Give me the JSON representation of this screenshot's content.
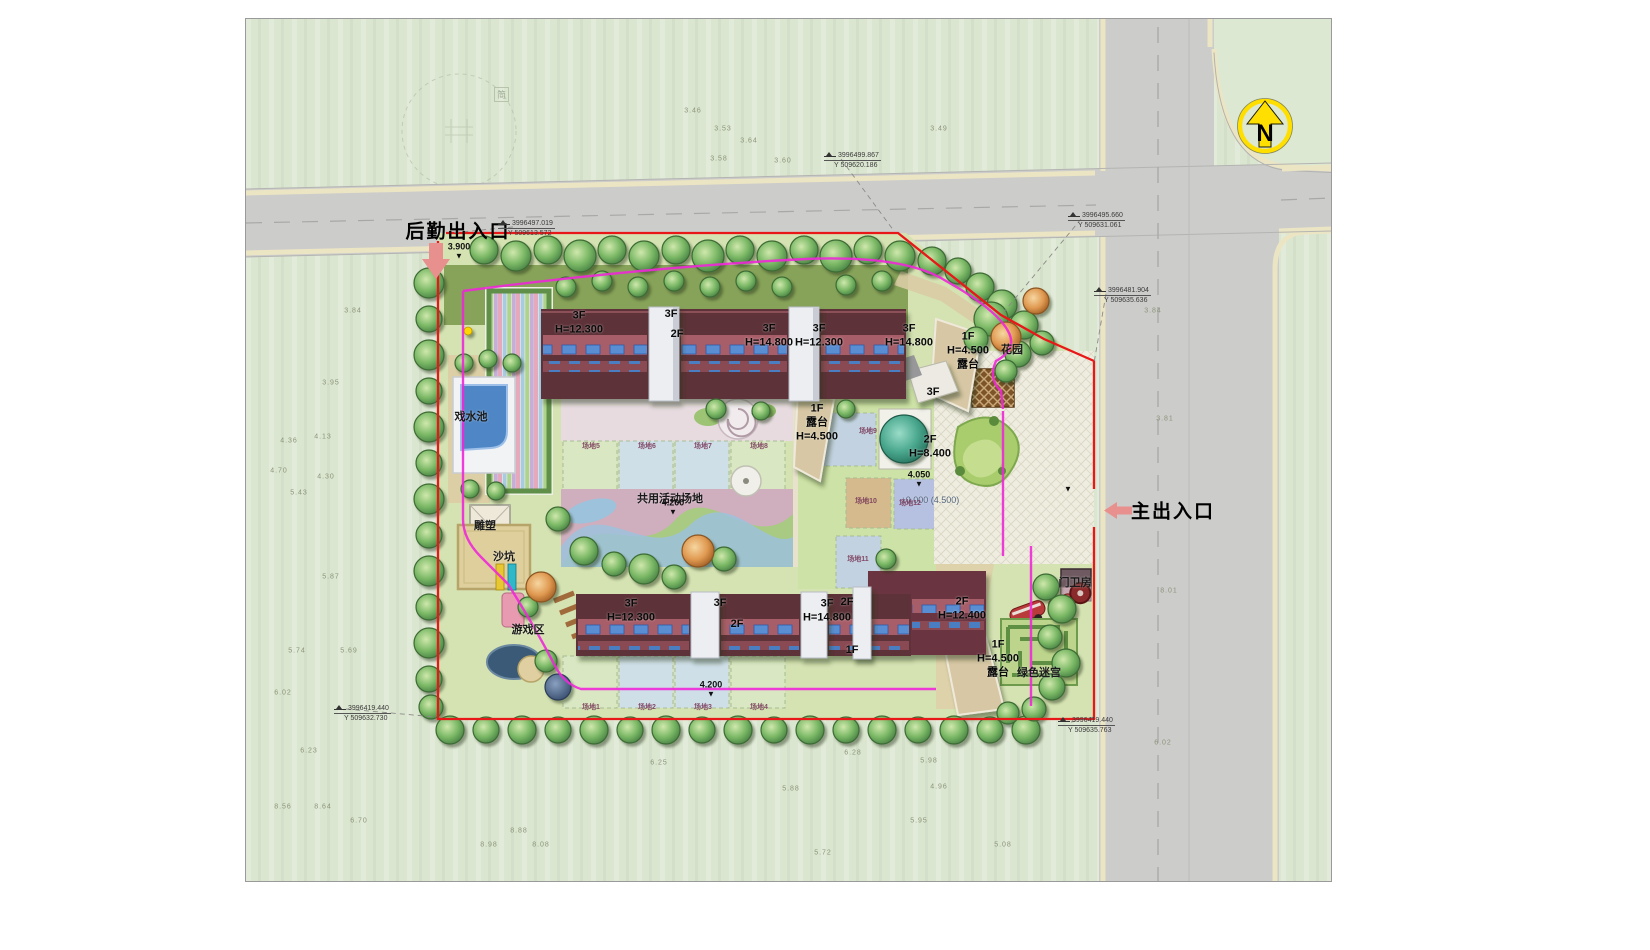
{
  "sheet": {
    "watermark": "简"
  },
  "north_arrow": {
    "letter": "N"
  },
  "entrances": {
    "service": {
      "label": "后勤出入口"
    },
    "main": {
      "label": "主出入口"
    }
  },
  "building_labels": [
    {
      "x": 333,
      "y": 304,
      "text": "3F\nH=12.300"
    },
    {
      "x": 425,
      "y": 296,
      "text": "3F"
    },
    {
      "x": 431,
      "y": 316,
      "text": "2F"
    },
    {
      "x": 523,
      "y": 317,
      "text": "3F\nH=14.800"
    },
    {
      "x": 573,
      "y": 317,
      "text": "3F\nH=12.300"
    },
    {
      "x": 663,
      "y": 317,
      "text": "3F\nH=14.800"
    },
    {
      "x": 722,
      "y": 332,
      "text": "1F\nH=4.500\n露台"
    },
    {
      "x": 687,
      "y": 374,
      "text": "3F"
    },
    {
      "x": 571,
      "y": 404,
      "text": "1F\n露台\nH=4.500"
    },
    {
      "x": 684,
      "y": 428,
      "text": "2F\nH=8.400"
    },
    {
      "x": 385,
      "y": 592,
      "text": "3F\nH=12.300"
    },
    {
      "x": 474,
      "y": 585,
      "text": "3F"
    },
    {
      "x": 491,
      "y": 606,
      "text": "2F"
    },
    {
      "x": 581,
      "y": 592,
      "text": "3F\nH=14.800"
    },
    {
      "x": 601,
      "y": 584,
      "text": "2F"
    },
    {
      "x": 606,
      "y": 632,
      "text": "1F"
    },
    {
      "x": 716,
      "y": 590,
      "text": "2F\nH=12.400"
    },
    {
      "x": 752,
      "y": 640,
      "text": "1F\nH=4.500\n露台"
    }
  ],
  "facility_labels": [
    {
      "x": 225,
      "y": 397,
      "text": "戏水池"
    },
    {
      "x": 239,
      "y": 506,
      "text": "雕塑"
    },
    {
      "x": 258,
      "y": 537,
      "text": "沙坑"
    },
    {
      "x": 282,
      "y": 610,
      "text": "游戏区"
    },
    {
      "x": 424,
      "y": 479,
      "text": "共用活动场地"
    },
    {
      "x": 766,
      "y": 330,
      "text": "花园"
    },
    {
      "x": 829,
      "y": 563,
      "text": "门卫房"
    },
    {
      "x": 793,
      "y": 653,
      "text": "绿色迷宫"
    },
    {
      "x": 684,
      "y": 481,
      "text": "±0.000 (4.500)",
      "cls": "muted"
    }
  ],
  "plot_labels": [
    {
      "x": 345,
      "y": 688,
      "text": "场地1"
    },
    {
      "x": 401,
      "y": 688,
      "text": "场地2"
    },
    {
      "x": 457,
      "y": 688,
      "text": "场地3"
    },
    {
      "x": 513,
      "y": 688,
      "text": "场地4"
    },
    {
      "x": 345,
      "y": 427,
      "text": "场地5"
    },
    {
      "x": 401,
      "y": 427,
      "text": "场地6"
    },
    {
      "x": 457,
      "y": 427,
      "text": "场地7"
    },
    {
      "x": 513,
      "y": 427,
      "text": "场地8"
    },
    {
      "x": 622,
      "y": 412,
      "text": "场地9"
    },
    {
      "x": 620,
      "y": 482,
      "text": "场地10"
    },
    {
      "x": 612,
      "y": 540,
      "text": "场地11"
    },
    {
      "x": 664,
      "y": 484,
      "text": "场地12"
    }
  ],
  "elevation_markers": [
    {
      "x": 213,
      "y": 232,
      "value": "3.900"
    },
    {
      "x": 427,
      "y": 488,
      "value": "4.200"
    },
    {
      "x": 465,
      "y": 670,
      "value": "4.200"
    },
    {
      "x": 673,
      "y": 460,
      "value": "4.050"
    },
    {
      "x": 822,
      "y": 470,
      "value": ""
    }
  ],
  "survey_markers": [
    {
      "x": 252,
      "y": 200,
      "line1": "3996497.019",
      "line2": "Y 509613.572"
    },
    {
      "x": 578,
      "y": 132,
      "line1": "3996499.867",
      "line2": "Y 509620.186"
    },
    {
      "x": 822,
      "y": 192,
      "line1": "3996495.660",
      "line2": "Y 509631.061"
    },
    {
      "x": 848,
      "y": 267,
      "line1": "3996481.904",
      "line2": "Y 509635.636"
    },
    {
      "x": 88,
      "y": 685,
      "line1": "3996419.440",
      "line2": "Y 509632.730"
    },
    {
      "x": 812,
      "y": 697,
      "line1": "3996419.440",
      "line2": "Y 509635.763"
    }
  ],
  "spot_elevations": [
    {
      "x": 107,
      "y": 292,
      "v": "3.84"
    },
    {
      "x": 85,
      "y": 364,
      "v": "3.95"
    },
    {
      "x": 43,
      "y": 422,
      "v": "4.36"
    },
    {
      "x": 77,
      "y": 418,
      "v": "4.13"
    },
    {
      "x": 33,
      "y": 452,
      "v": "4.70"
    },
    {
      "x": 80,
      "y": 458,
      "v": "4.30"
    },
    {
      "x": 53,
      "y": 474,
      "v": "5.43"
    },
    {
      "x": 85,
      "y": 558,
      "v": "5.87"
    },
    {
      "x": 51,
      "y": 632,
      "v": "5.74"
    },
    {
      "x": 103,
      "y": 632,
      "v": "5.69"
    },
    {
      "x": 37,
      "y": 674,
      "v": "6.02"
    },
    {
      "x": 63,
      "y": 732,
      "v": "6.23"
    },
    {
      "x": 77,
      "y": 788,
      "v": "8.64"
    },
    {
      "x": 37,
      "y": 788,
      "v": "8.56"
    },
    {
      "x": 113,
      "y": 802,
      "v": "6.70"
    },
    {
      "x": 243,
      "y": 826,
      "v": "8.98"
    },
    {
      "x": 273,
      "y": 812,
      "v": "8.88"
    },
    {
      "x": 295,
      "y": 826,
      "v": "8.08"
    },
    {
      "x": 447,
      "y": 92,
      "v": "3.46"
    },
    {
      "x": 477,
      "y": 110,
      "v": "3.53"
    },
    {
      "x": 503,
      "y": 122,
      "v": "3.64"
    },
    {
      "x": 693,
      "y": 110,
      "v": "3.49"
    },
    {
      "x": 473,
      "y": 140,
      "v": "3.58"
    },
    {
      "x": 537,
      "y": 142,
      "v": "3.60"
    },
    {
      "x": 607,
      "y": 734,
      "v": "6.28"
    },
    {
      "x": 545,
      "y": 770,
      "v": "5.88"
    },
    {
      "x": 413,
      "y": 744,
      "v": "6.25"
    },
    {
      "x": 683,
      "y": 742,
      "v": "5.98"
    },
    {
      "x": 673,
      "y": 802,
      "v": "5.95"
    },
    {
      "x": 577,
      "y": 834,
      "v": "5.72"
    },
    {
      "x": 757,
      "y": 826,
      "v": "5.08"
    },
    {
      "x": 693,
      "y": 768,
      "v": "4.96"
    },
    {
      "x": 907,
      "y": 292,
      "v": "3.84"
    },
    {
      "x": 919,
      "y": 400,
      "v": "3.81"
    },
    {
      "x": 923,
      "y": 572,
      "v": "8.01"
    },
    {
      "x": 917,
      "y": 724,
      "v": "6.02"
    }
  ],
  "colors": {
    "boundary_line": "#e81818",
    "flow_line": "#ef28d8",
    "road": "#cccccb",
    "curb": "#ece5c4",
    "north_yellow": "#ffdf00",
    "roof_dark": "#5d3038",
    "entrance_arrow": "#e8908e"
  }
}
